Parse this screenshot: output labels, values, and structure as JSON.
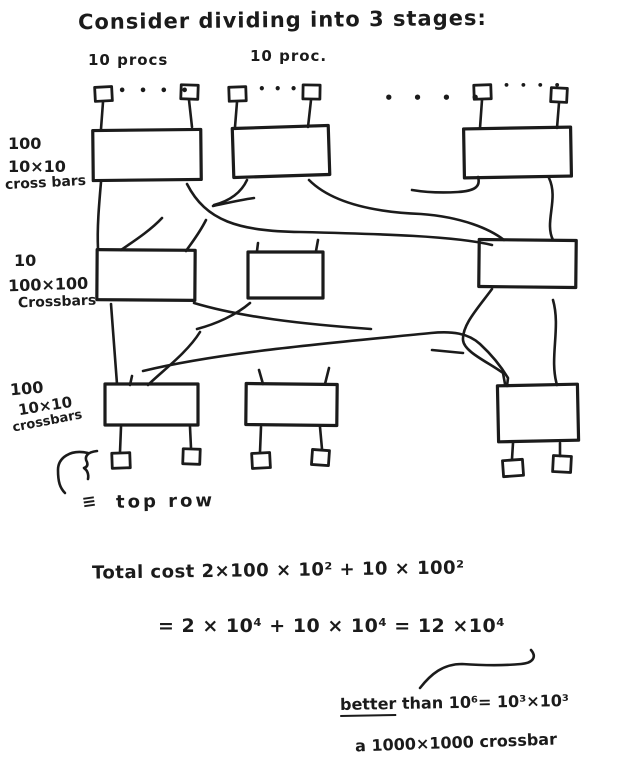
{
  "title": "Consider dividing into 3 stages:",
  "columns": {
    "col1": "10 procs",
    "col2": "10 proc."
  },
  "ellipses": {
    "group1": "• • • •",
    "group2": "• • •",
    "middle": "• • • •",
    "group3": "• • • •"
  },
  "stages": [
    {
      "count": "100",
      "size": "10×10",
      "kind": "cross bars"
    },
    {
      "count": "10",
      "size": "100×100",
      "kind": "Crossbars"
    },
    {
      "count": "100",
      "size": "10×10",
      "kind": "crossbars"
    }
  ],
  "bottom_note": {
    "equiv_symbol": "≡",
    "label": "top row"
  },
  "math": {
    "cost_line": "Total cost 2×100 × 10²  +  10 × 100²",
    "sum_line": "=  2 × 10⁴  +   10 × 10⁴   =  12 ×10⁴",
    "better_word": "better",
    "better_rest": " than  10⁶= 10³×10³",
    "conclusion": "a 1000×1000 crossbar"
  },
  "ink_color": "#1b1b1b"
}
